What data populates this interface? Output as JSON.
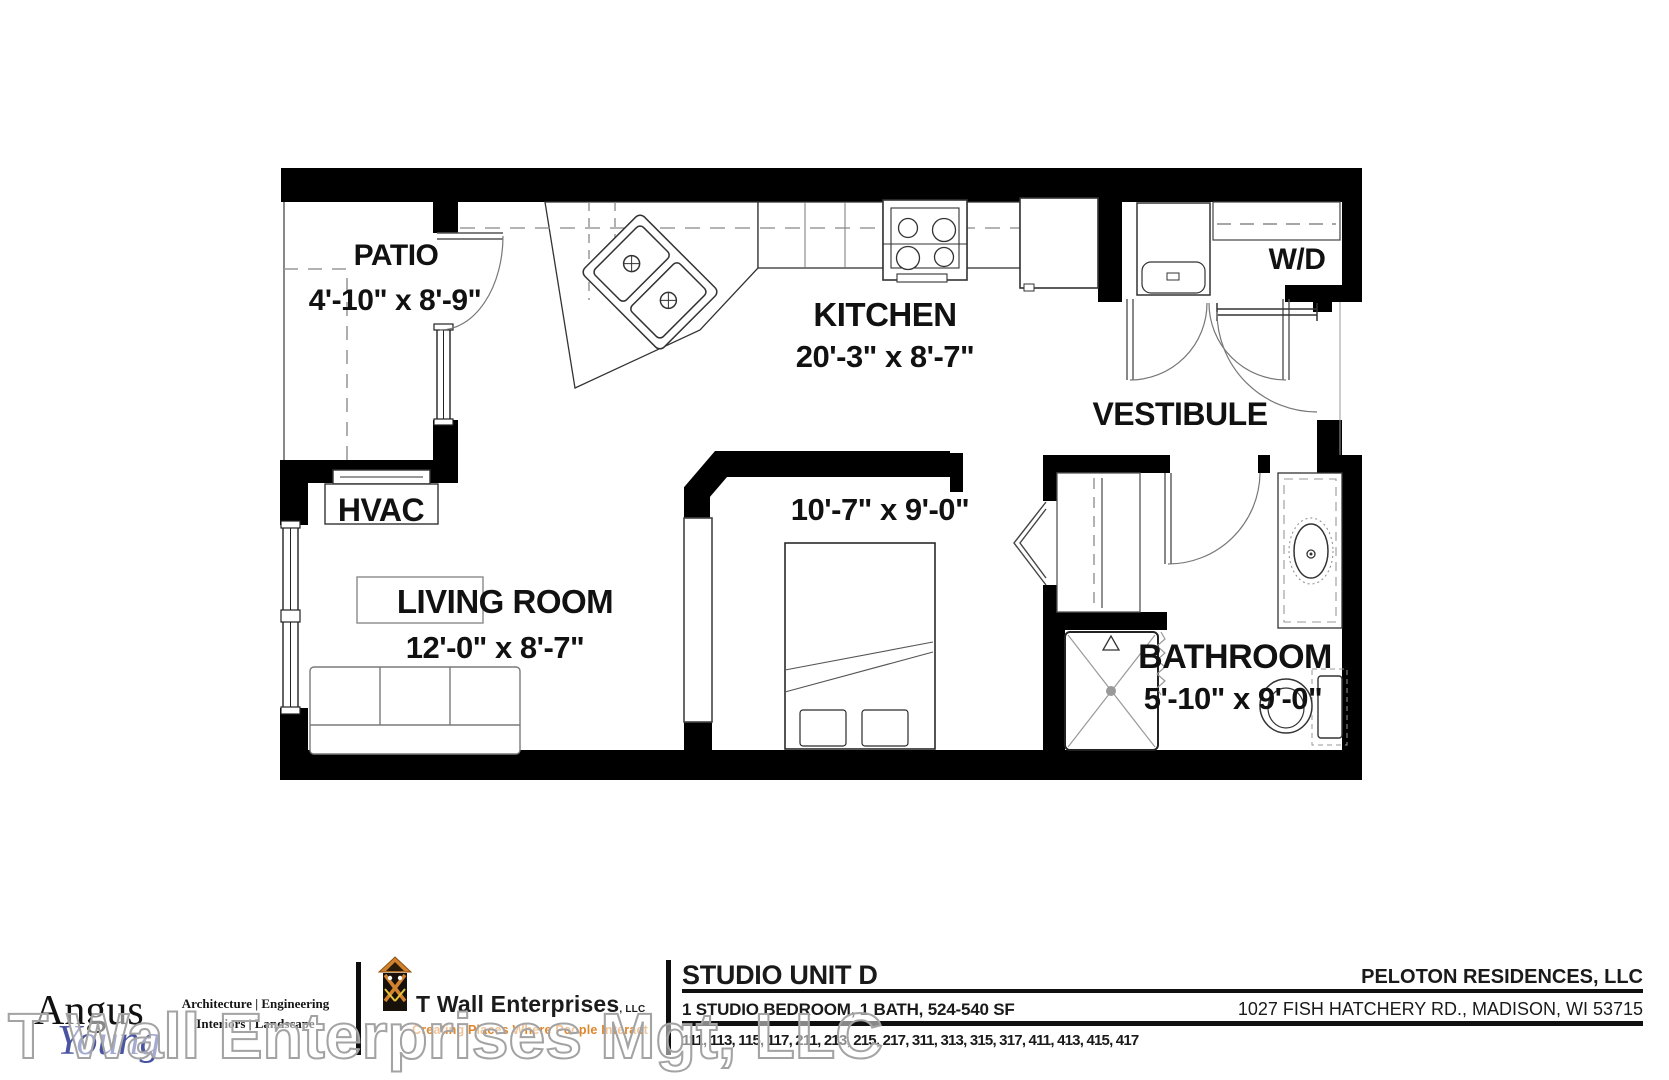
{
  "rooms": {
    "patio": {
      "label": "PATIO",
      "dims": "4'-10\" x 8'-9\""
    },
    "kitchen": {
      "label": "KITCHEN",
      "dims": "20'-3\" x 8'-7\""
    },
    "laundry": {
      "label": "W/D"
    },
    "vestibule": {
      "label": "VESTIBULE"
    },
    "hvac": {
      "label": "HVAC"
    },
    "living_room": {
      "label": "LIVING ROOM",
      "dims": "12'-0\" x 8'-7\""
    },
    "sleeping_area": {
      "dims": "10'-7\" x 9'-0\""
    },
    "bathroom": {
      "label": "BATHROOM",
      "dims": "5'-10\" x 9'-0\""
    }
  },
  "title_block": {
    "architect": {
      "name_top": "Angus",
      "name_bottom": "Young",
      "services_line1": "Architecture | Engineering",
      "services_line2": "Interiors | Landscape"
    },
    "developer": {
      "name": "T Wall Enterprises",
      "suffix": ", LLC",
      "tagline": "Creating Places Where People Interact"
    },
    "unit": {
      "title": "STUDIO UNIT D",
      "summary": "1 STUDIO BEDROOM, 1 BATH, 524-540 SF",
      "unit_numbers": "111, 113, 115, 117, 211, 213, 215, 217, 311, 313, 315, 317, 411, 413, 415, 417"
    },
    "owner": {
      "name": "PELOTON RESIDENCES, LLC",
      "address": "1027 FISH HATCHERY RD., MADISON, WI 53715"
    }
  },
  "watermark": {
    "text": "T Wall Enterprises Mgt, LLC"
  },
  "colors": {
    "wall_black": "#000000",
    "brand_blue": "#4a55a2",
    "accent_orange": "#e0862c"
  }
}
